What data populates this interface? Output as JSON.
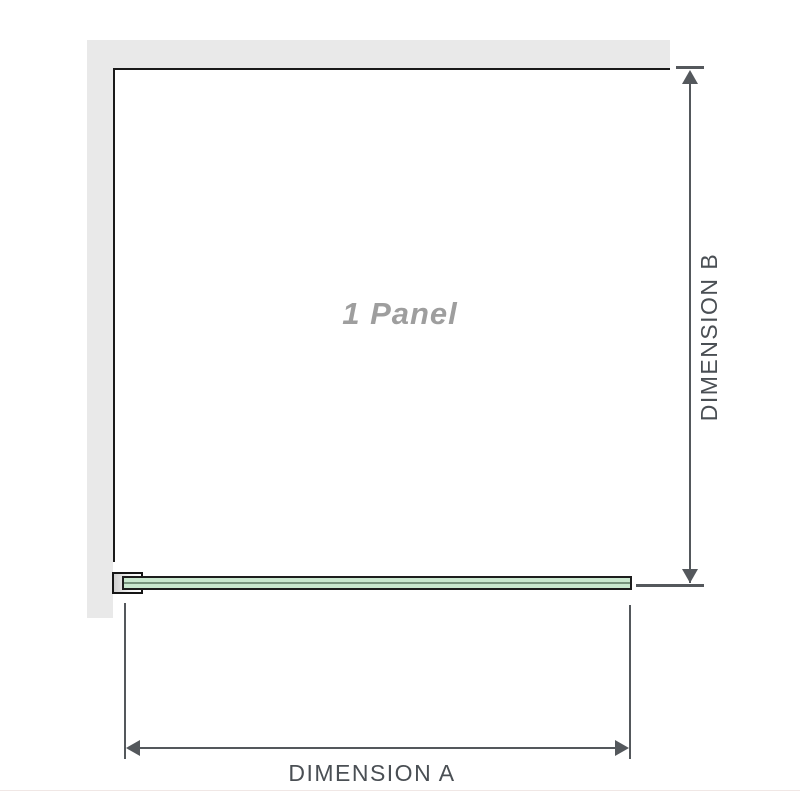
{
  "diagram": {
    "title": "Shower screen single panel configuration diagram",
    "panel_label": "1 Panel",
    "dimension_a_label": "DIMENSION A",
    "dimension_b_label": "DIMENSION B"
  },
  "colors": {
    "wall_fill": "#e9e9e9",
    "panel_outline": "#1a1a1a",
    "dimension_line": "#54585c",
    "dimension_text": "#4a4f54",
    "panel_label_text": "#9e9e9e",
    "glass_fill": "#c9e8cf",
    "glass_core_line": "#76937c",
    "bracket_border": "#151515",
    "bottom_divider": "#f0e7e5"
  }
}
